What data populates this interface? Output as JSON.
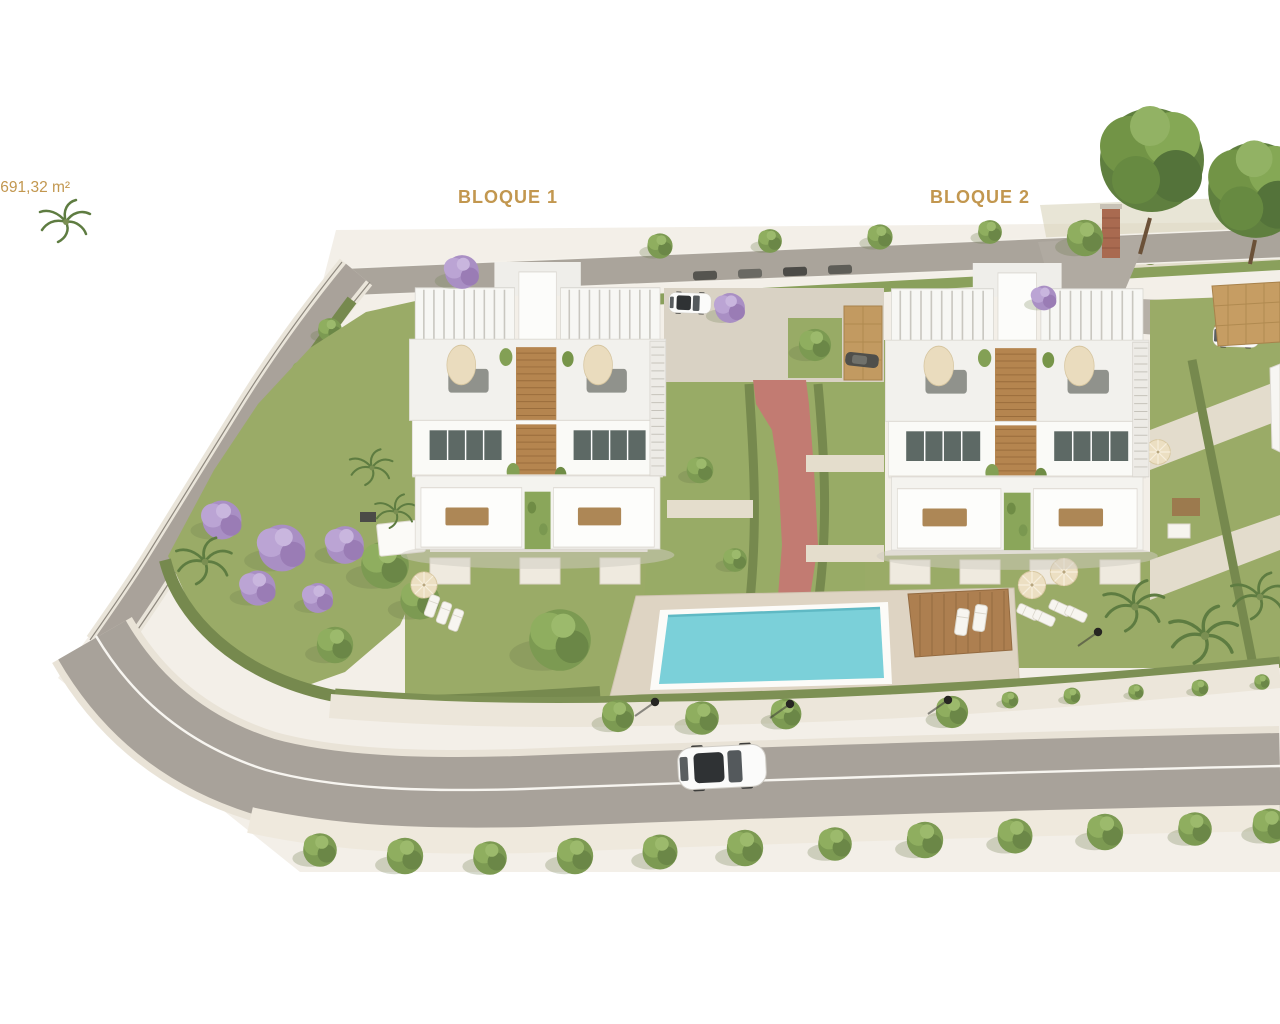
{
  "scene": {
    "type": "aerial-3d-architectural-render",
    "subject": "Residential development site with two apartment blocks, communal pool, gardens, perimeter roads and parked cars"
  },
  "labels": {
    "area_measurement": ".691,32 m²",
    "block_1": "BLOQUE 1",
    "block_2": "BLOQUE 2"
  },
  "colors": {
    "label_text": "#c2974f",
    "background": "#ffffff",
    "terrain": "#f3efe8",
    "lawn": "#9aab67",
    "road": "#a8a29a",
    "pool_water": "#7bd0d9",
    "red_path": "#c27b72",
    "wood_deck": "#ad7f50",
    "building_white": "#f6f5f2",
    "hedge": "#76894e"
  }
}
